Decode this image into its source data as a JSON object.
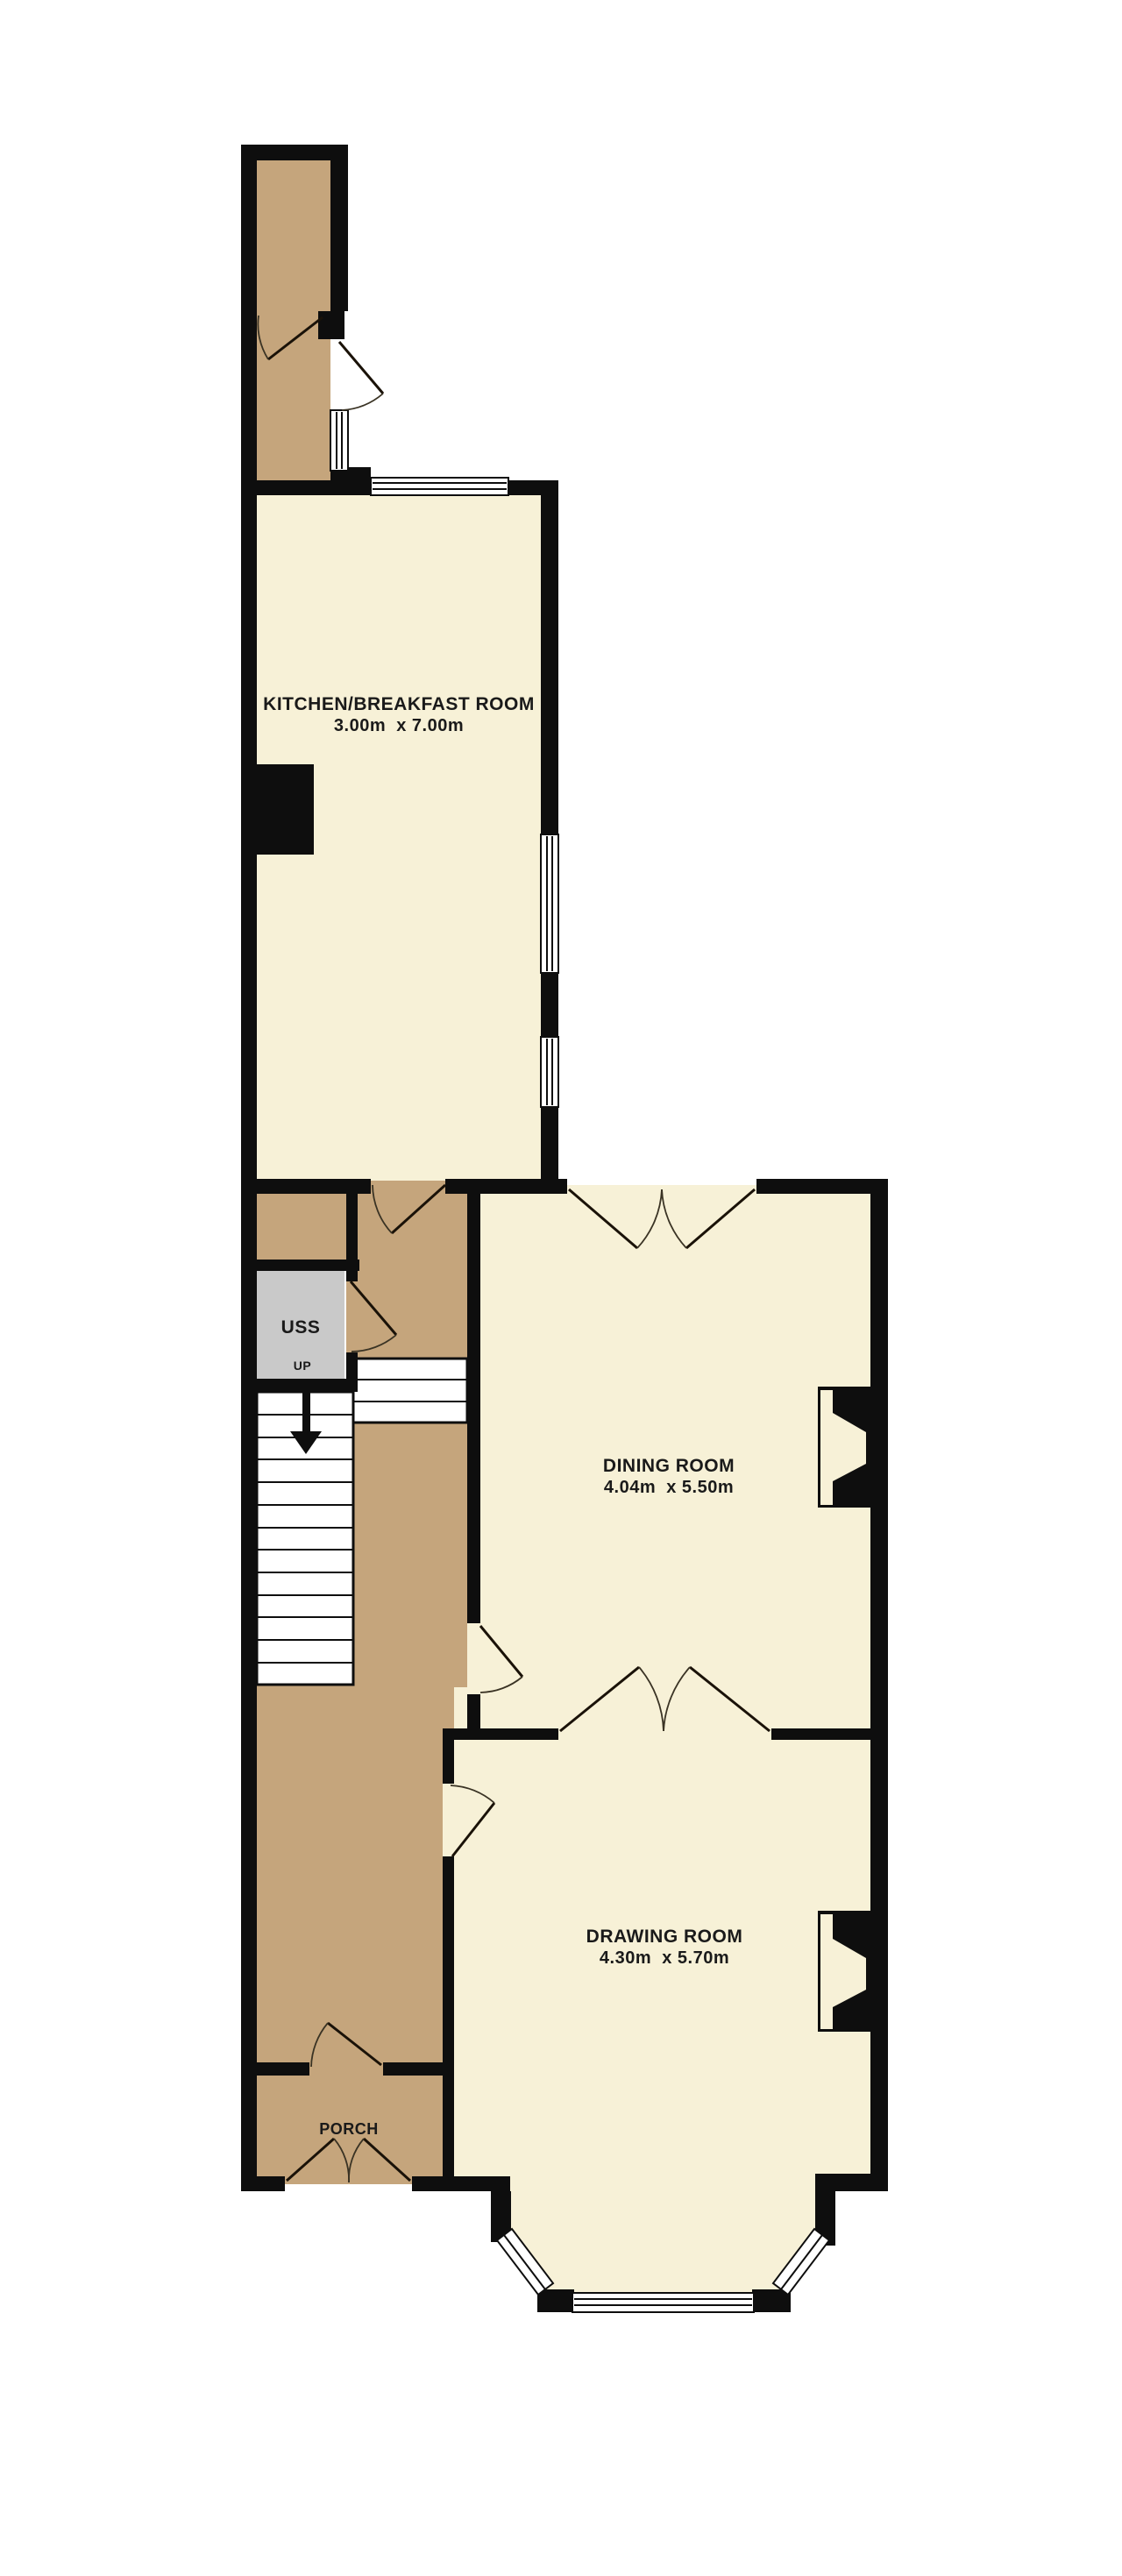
{
  "plan": {
    "rooms": {
      "kitchen": {
        "name": "KITCHEN/BREAKFAST ROOM",
        "dimensions": "3.00m  x 7.00m"
      },
      "dining": {
        "name": "DINING ROOM",
        "dimensions": "4.04m  x 5.50m"
      },
      "drawing": {
        "name": "DRAWING ROOM",
        "dimensions": "4.30m  x 5.70m"
      },
      "porch": {
        "name": "PORCH"
      },
      "understairs": {
        "name": "USS",
        "stair_label": "UP"
      }
    },
    "colors": {
      "wall": "#0e0e0e",
      "room_fill": "#f7f1d7",
      "circulation_fill": "#c5a57c",
      "cupboard_fill": "#c9c9c9",
      "window_fill": "#ffffff"
    }
  }
}
